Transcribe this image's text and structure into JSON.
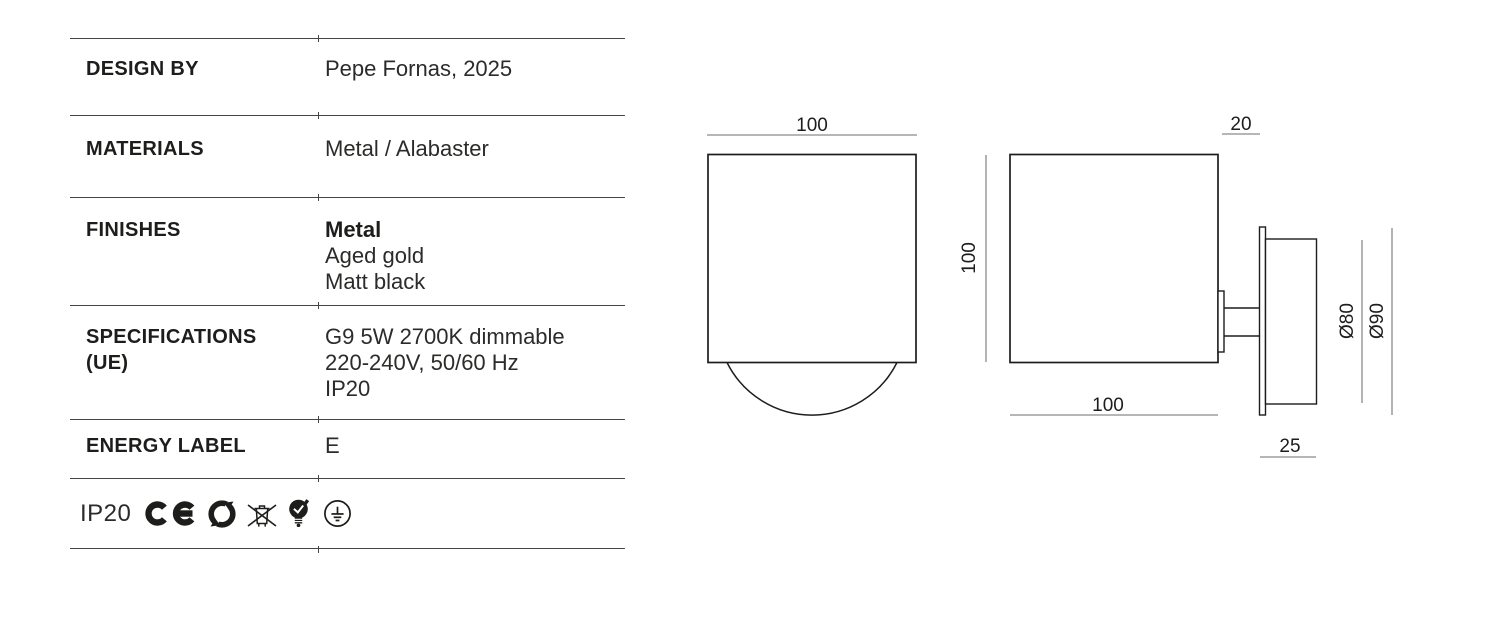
{
  "colors": {
    "background": "#ffffff",
    "text": "#1d1d1b",
    "drawing_line": "#1d1d1b",
    "dimension_line": "#8a8a8a",
    "table_rule": "#454543"
  },
  "spec_table": {
    "rows": [
      {
        "label": "DESIGN BY",
        "lines": [
          "Pepe Fornas, 2025"
        ]
      },
      {
        "label": "MATERIALS",
        "lines": [
          "Metal / Alabaster"
        ]
      },
      {
        "label": "FINISHES",
        "lines": [
          "Metal",
          "Aged gold",
          "Matt black"
        ]
      },
      {
        "label": "SPECIFICATIONS (UE)",
        "lines": [
          "G9 5W 2700K dimmable",
          "220-240V, 50/60 Hz",
          "IP20"
        ]
      },
      {
        "label": "ENERGY LABEL",
        "lines": [
          "E"
        ]
      }
    ]
  },
  "certifications": {
    "ip_rating": "IP20",
    "icons": [
      "ce-mark",
      "green-dot-recycling",
      "weee-crossed-out-bin",
      "bulb-energy-check",
      "protective-earth-class1"
    ]
  },
  "drawings": {
    "front_view": {
      "width_dim": "100",
      "height_dim": "100"
    },
    "side_view": {
      "wall_gap_dim": "20",
      "depth_dim": "100",
      "canopy_depth_dim": "25",
      "inner_dia_dim": "Ø80",
      "outer_dia_dim": "Ø90"
    }
  }
}
